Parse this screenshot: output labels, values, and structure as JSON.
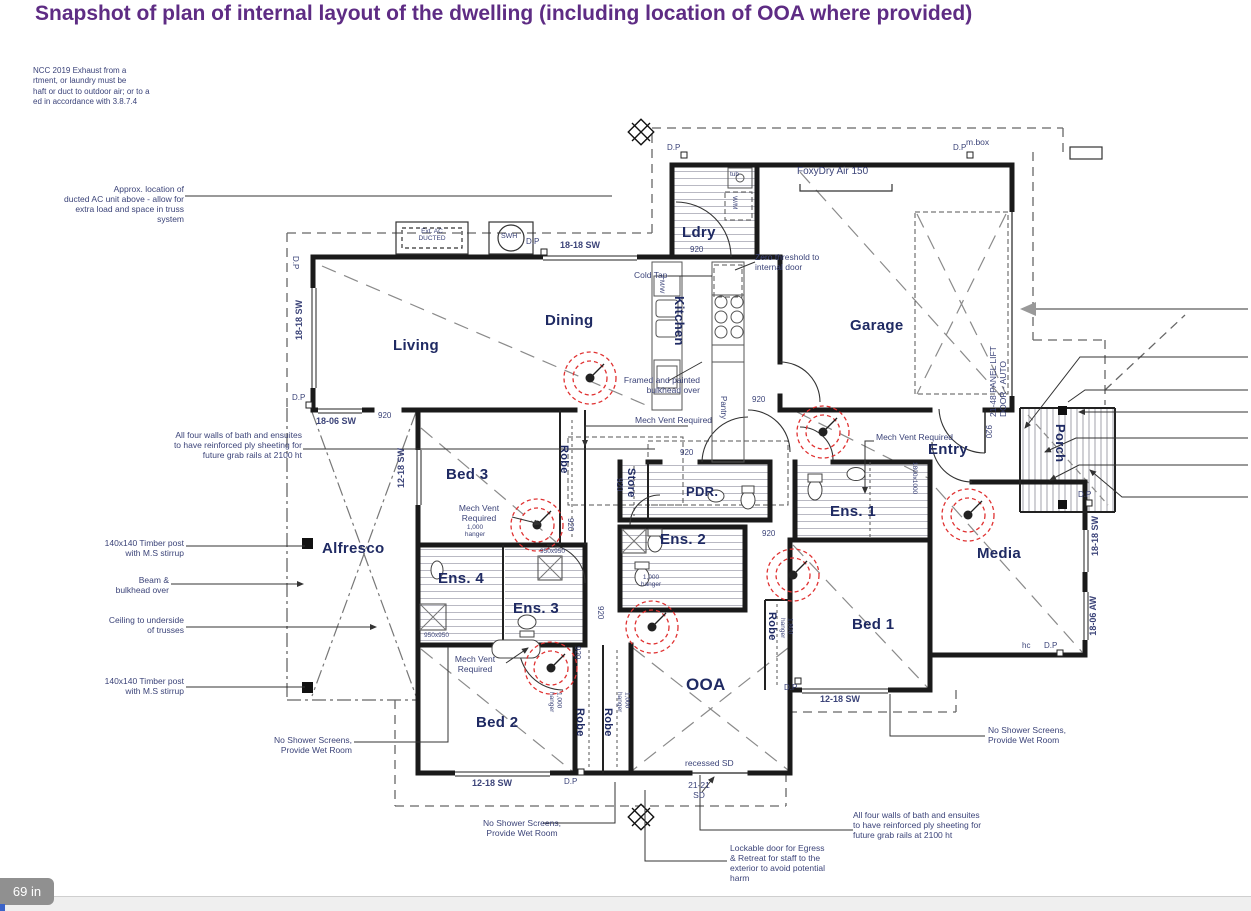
{
  "page": {
    "title": "Snapshot of plan of internal layout of the dwelling (including location of OOA where provided)",
    "badge": "69 in"
  },
  "notes": {
    "topleft": "NCC 2019 Exhaust from a\nrtment, or laundry must be\nhaft or duct to outdoor air; or to a\ned in accordance with 3.8.7.4"
  },
  "rooms": {
    "living": "Living",
    "dining": "Dining",
    "kitchen": "Kitchen",
    "ldry": "Ldry",
    "garage": "Garage",
    "entry": "Entry",
    "porch": "Porch",
    "media": "Media",
    "bed1": "Bed 1",
    "bed2": "Bed 2",
    "bed3": "Bed 3",
    "ens1": "Ens. 1",
    "ens2": "Ens. 2",
    "ens3": "Ens. 3",
    "ens4": "Ens. 4",
    "pdr": "PDR.",
    "ooa": "OOA",
    "alfresco": "Alfresco",
    "store": "Store",
    "robe": "Robe",
    "pantry": "Pantry"
  },
  "ann": {
    "ac": "Approx. location of\nducted AC unit above - allow for\nextra load and space in truss system",
    "ply": "All four walls of bath and ensuites\nto have reinforced ply sheeting for\nfuture grab rails at 2100 ht",
    "timber": "140x140 Timber post\nwith M.S stirrup",
    "beam": "Beam &\nbulkhead over",
    "ceiling": "Ceiling to underside\nof trusses",
    "wet": "No Shower Screens,\nProvide Wet Room",
    "lockable": "Lockable door for Egress\n& Retreat for staff to the\nexterior to avoid potential\nharm",
    "mech": "Mech Vent Required",
    "mech2": "Mech Vent\nRequired",
    "zero": "Zero threshold to\ninternal door",
    "cold": "Cold Tap",
    "framed": "Framed and painted\nbulkhead over",
    "foxy": "FoxyDry Air 150",
    "panel": "21-48 PANEL LIFT\nDOOR - AUTO",
    "recessed": "recessed SD",
    "sd": "21-21\nSD"
  },
  "fix": {
    "mbox": "m.box",
    "swh": "SWH",
    "extac": "Ext. AC\nDUCTED",
    "wm": "W/M",
    "mw": "M/W",
    "tub": "tub"
  },
  "dims": {
    "d920": "920",
    "dp": "D.P",
    "hc": "hc",
    "h1000": "1,000\nhanger",
    "h1800": "1,800\nhanger",
    "s950": "950x950",
    "s1800": "1800x1000"
  },
  "win": {
    "w1818": "18-18 SW",
    "w1806": "18-06 SW",
    "w1218": "12-18 SW",
    "w1806aw": "18-06 AW"
  }
}
